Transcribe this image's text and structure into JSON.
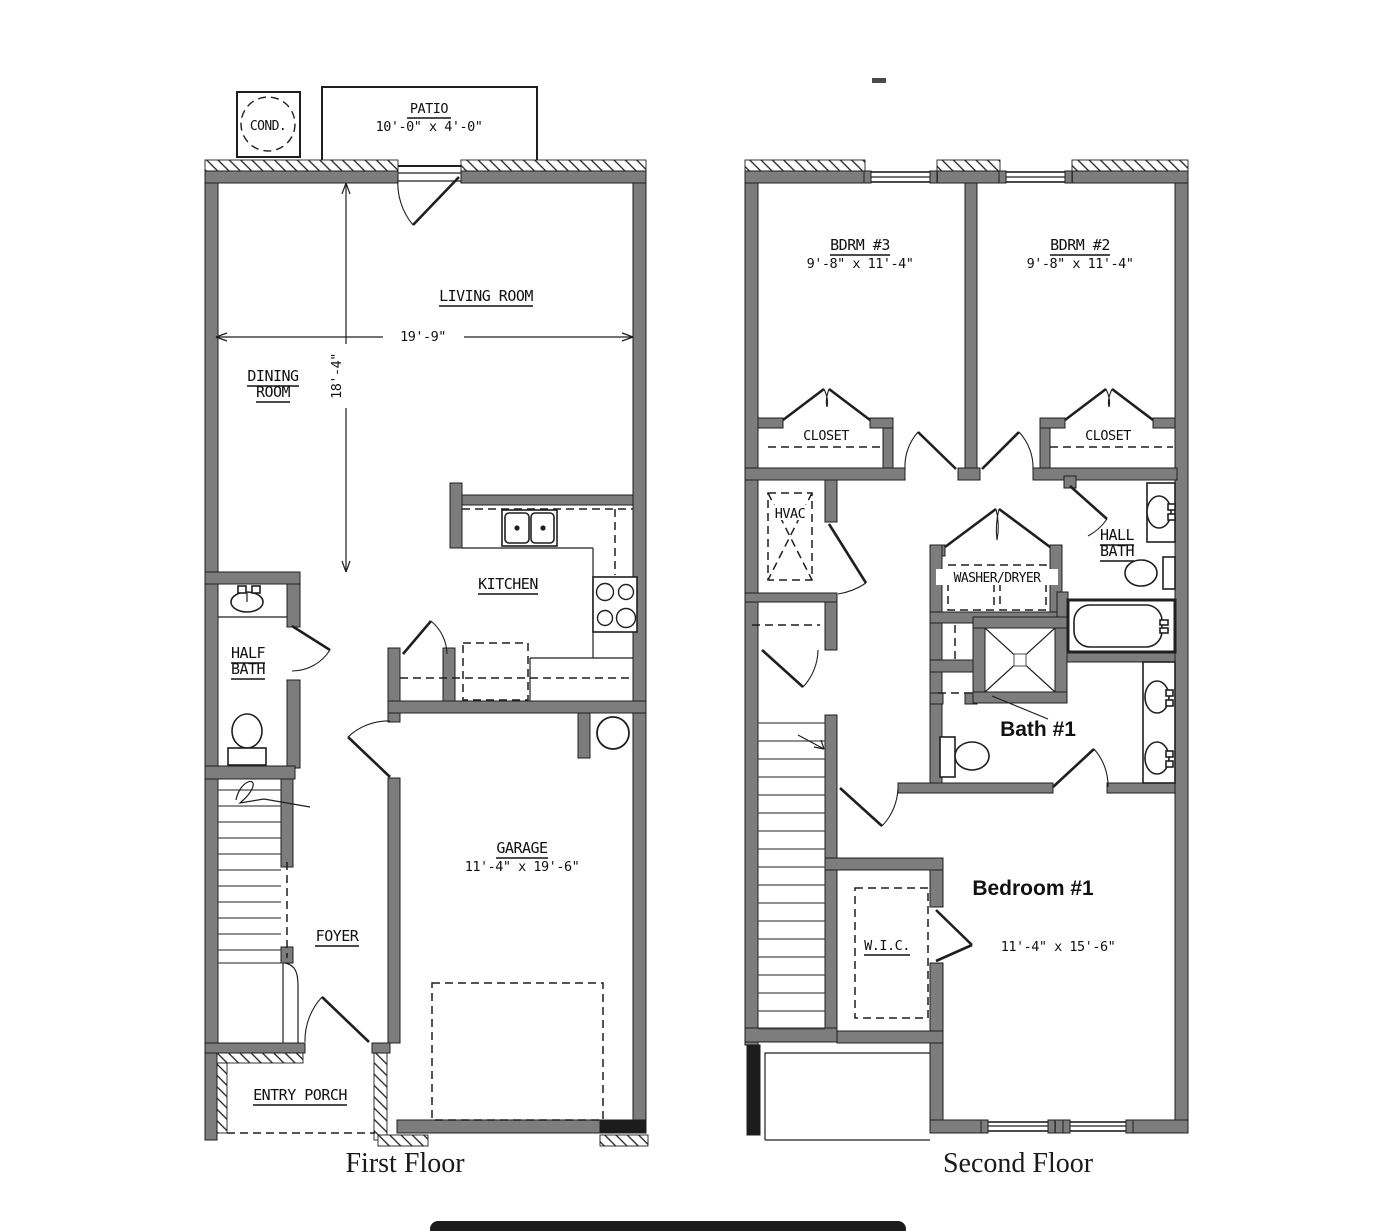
{
  "first_floor": {
    "caption": "First Floor",
    "cond": "COND.",
    "patio_label": "PATIO",
    "patio_dims": "10'-0\" x 4'-0\"",
    "living_room": "LIVING ROOM",
    "width_dim": "19'-9\"",
    "height_dim": "18'-4\"",
    "dining_line1": "DINING",
    "dining_line2": "ROOM",
    "kitchen": "KITCHEN",
    "half_bath_line1": "HALF",
    "half_bath_line2": "BATH",
    "garage_label": "GARAGE",
    "garage_dims": "11'-4\" x 19'-6\"",
    "foyer": "FOYER",
    "entry_porch": "ENTRY PORCH"
  },
  "second_floor": {
    "caption": "Second Floor",
    "bdrm3_label": "BDRM #3",
    "bdrm3_dims": "9'-8\" x 11'-4\"",
    "bdrm2_label": "BDRM #2",
    "bdrm2_dims": "9'-8\" x 11'-4\"",
    "closet_left": "CLOSET",
    "closet_right": "CLOSET",
    "hvac": "HVAC",
    "washer_dryer": "WASHER/DRYER",
    "hall_bath_line1": "HALL",
    "hall_bath_line2": "BATH",
    "bath1": "Bath #1",
    "bedroom1_label": "Bedroom #1",
    "bedroom1_dims": "11'-4\" x 15'-6\"",
    "wic": "W.I.C."
  },
  "colors": {
    "wall_gray": "#7d7d7d",
    "line_dark": "#1f1f1f",
    "scrollbar_dark": "#1c1c1c"
  }
}
